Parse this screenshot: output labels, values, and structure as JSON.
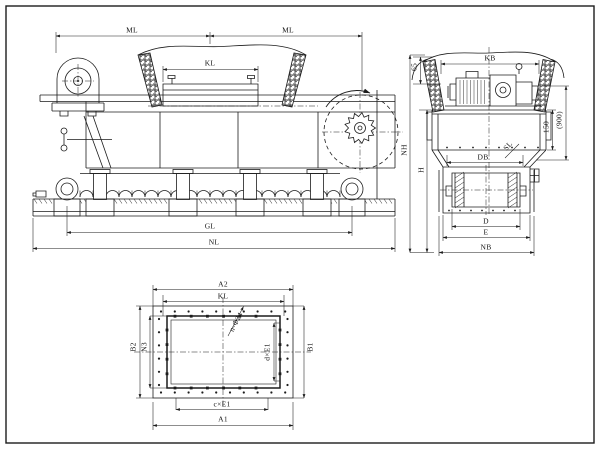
{
  "drawing": {
    "colors": {
      "line": "#1c1c1c",
      "paper": "#ffffff"
    },
    "views": {
      "side_elevation": {
        "labels": {
          "ml_left": "ML",
          "ml_right": "ML",
          "kl": "KL",
          "gl": "GL",
          "nl": "NL"
        }
      },
      "end_section": {
        "labels": {
          "kb": "KB",
          "h65": "65",
          "d150": "150",
          "d900": "(900)",
          "sl": "SL",
          "db": "DB",
          "nh": "NH",
          "h": "H",
          "d": "D",
          "e": "E",
          "nb": "NB"
        }
      },
      "plan_flange": {
        "labels": {
          "a2": "A2",
          "kl": "KL",
          "b2": "B2",
          "n3": "N3",
          "b1": "B1",
          "d_e1": "d×E1",
          "c_e1": "c×E1",
          "a1": "A1",
          "holes": "n-Φ24"
        }
      }
    }
  }
}
